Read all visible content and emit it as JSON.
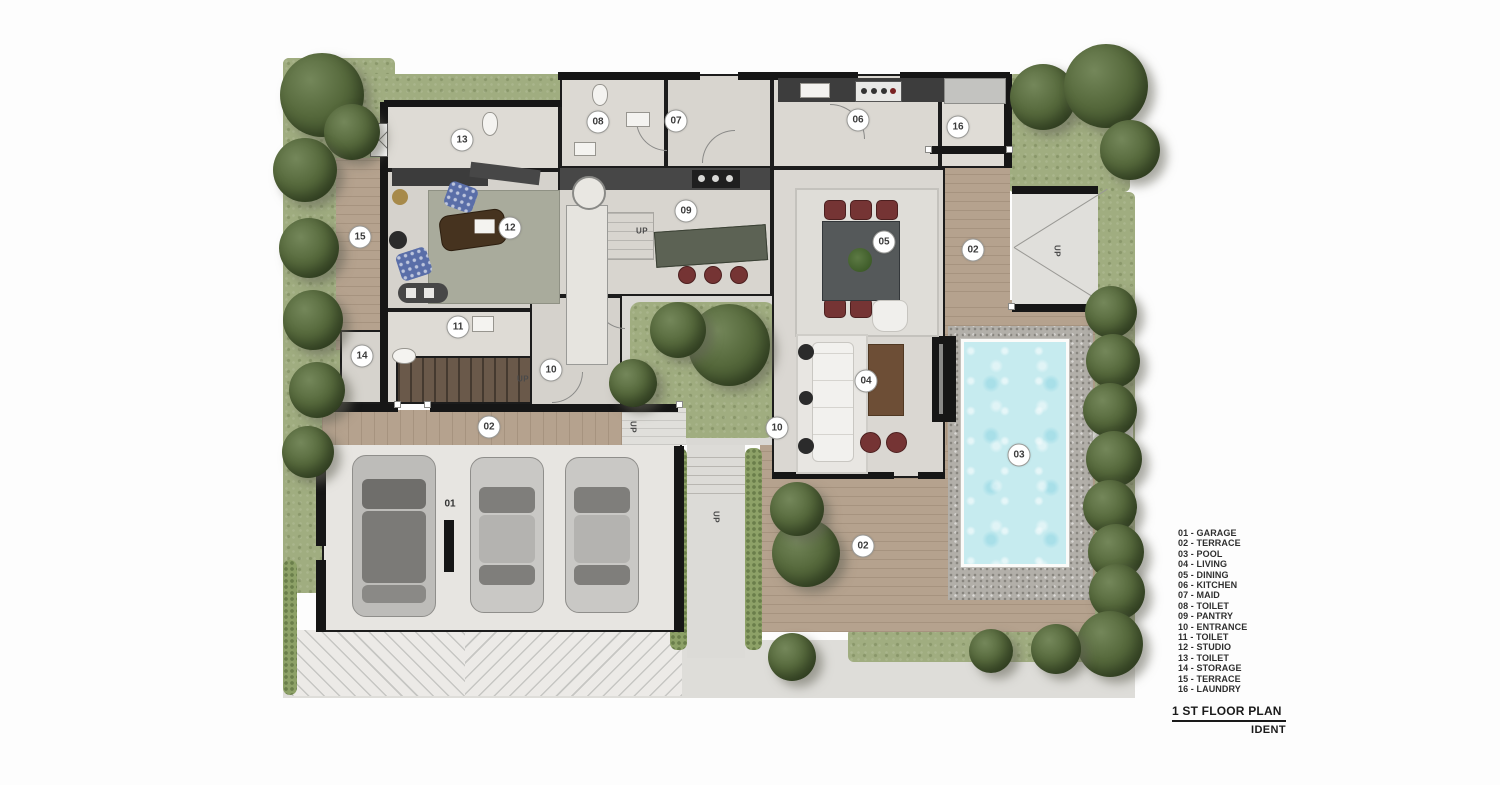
{
  "title_block": {
    "title": "1 ST FLOOR PLAN",
    "subtitle": "IDENT"
  },
  "legend": {
    "items": [
      "01 - GARAGE",
      "02 - TERRACE",
      "03 - POOL",
      "04 - LIVING",
      "05 - DINING",
      "06 - KITCHEN",
      "07 - MAID",
      "08 - TOILET",
      "09 - PANTRY",
      "10 - ENTRANCE",
      "11 - TOILET",
      "12 - STUDIO",
      "13 - TOILET",
      "14 - STORAGE",
      "15 - TERRACE",
      "16 - LAUNDRY"
    ]
  },
  "plan": {
    "room_labels": [
      {
        "text": "13"
      },
      {
        "text": "08"
      },
      {
        "text": "07"
      },
      {
        "text": "06"
      },
      {
        "text": "16"
      },
      {
        "text": "15"
      },
      {
        "text": "12"
      },
      {
        "text": "09"
      },
      {
        "text": "05"
      },
      {
        "text": "02"
      },
      {
        "text": "11"
      },
      {
        "text": "14"
      },
      {
        "text": "10"
      },
      {
        "text": "04"
      },
      {
        "text": "02"
      },
      {
        "text": "10"
      },
      {
        "text": "03"
      },
      {
        "text": "01"
      },
      {
        "text": "02"
      }
    ],
    "direction_labels": [
      {
        "text": "UP"
      },
      {
        "text": "UP"
      },
      {
        "text": "UP"
      },
      {
        "text": "UP"
      },
      {
        "text": "UP"
      }
    ],
    "colors": {
      "grass": "#a0ad80",
      "wood_deck": "#b5a28e",
      "pool_water": "#c6ebef",
      "gravel": "#b2afa9",
      "wall": "#161616",
      "floor": "#dcd9d3",
      "tree_foliage": "#56693c",
      "chair_accent": "#753434"
    }
  }
}
